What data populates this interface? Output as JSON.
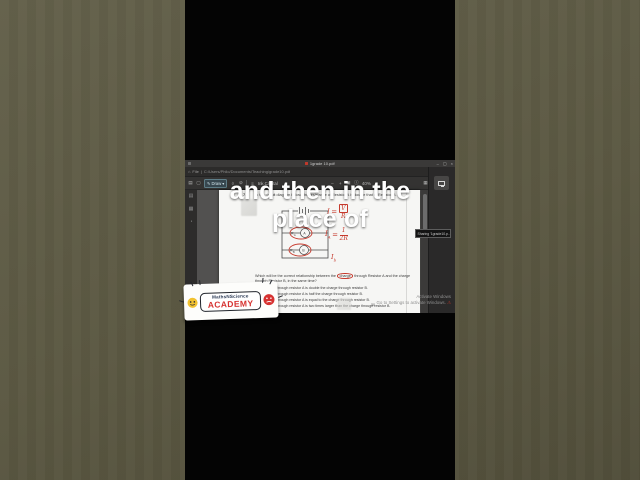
{
  "caption": {
    "line1": "and then in the",
    "line2": "place of"
  },
  "logo": {
    "brand": "MathsNScience",
    "academy": "ACADEMY"
  },
  "titlebar": {
    "title": "1grade 10.pdf",
    "minimize": "–",
    "maximize": "▢",
    "close": "×"
  },
  "pathbar": {
    "home_icon": "⌂",
    "file_label": "File",
    "separator": "|",
    "path": "C:/Users/Philo/Documents/Teaching/grade10.pdf",
    "star_icon": "☆",
    "menu_icon": "≡"
  },
  "toolbar": {
    "pages_icon": "▤",
    "select_icon": "▢",
    "pen_icon": "✎",
    "draw_label": "Draw",
    "caret_icon": "▾",
    "eraser_icon": "◊",
    "lasso_icon": "⊘",
    "style_icon": "≡",
    "tool_label": "Ink Capital",
    "zoom_out": "–",
    "zoom_in": "+",
    "fit_icon": "▣",
    "info_icon": "ⓘ",
    "zoom_level": "40%",
    "grid_icon": "▦",
    "rotate_icon": "⟳",
    "more_icon": "⋯",
    "panel_icon": "◫"
  },
  "sidebar": {
    "icons": [
      "▤",
      "▦",
      "◔",
      "▢"
    ]
  },
  "pdf": {
    "question_number": "7.5",
    "intro": "In the circuit diagram below, the resistance of Resistor A is double that of Resistor B.",
    "circuit": {
      "ra_base": "R",
      "ra_sub": "A",
      "rb_base": "R",
      "rb_sub": "B"
    },
    "handwriting": {
      "equals": "=",
      "i1": "I",
      "f1_num": "V",
      "f1_den": "R",
      "i2": "I",
      "i2_sub": "A",
      "f2_num": "1",
      "f2_den": "2R",
      "i3": "I",
      "i3_sub": "b"
    },
    "question_pre": "Which will be the correct relationship between the ",
    "question_circled": "charge",
    "question_post": " through Resistor A and the charge through Resistor B, in the same time?",
    "options": [
      {
        "label": "A",
        "text": "The charge through resistor A is double the charge through resistor B."
      },
      {
        "label": "B",
        "text": "The charge through resistor A is half the charge through resistor B."
      },
      {
        "label": "C",
        "text": "The charge through resistor A is equal to the charge through resistor B."
      },
      {
        "label": "D",
        "text": "The charge through resistor A is two times larger than the charge through resistor B."
      }
    ],
    "page_number": "30"
  },
  "share_panel": {
    "tooltip": "Sharing '1grade10.p...'"
  },
  "watermark": {
    "line1": "Activate Windows",
    "line2": "Go to Settings to activate Windows.",
    "warning_icon": "⚠"
  },
  "colors": {
    "ink_red": "#c6392c",
    "academy_red": "#d63230",
    "accent_chip": "#37474f"
  }
}
